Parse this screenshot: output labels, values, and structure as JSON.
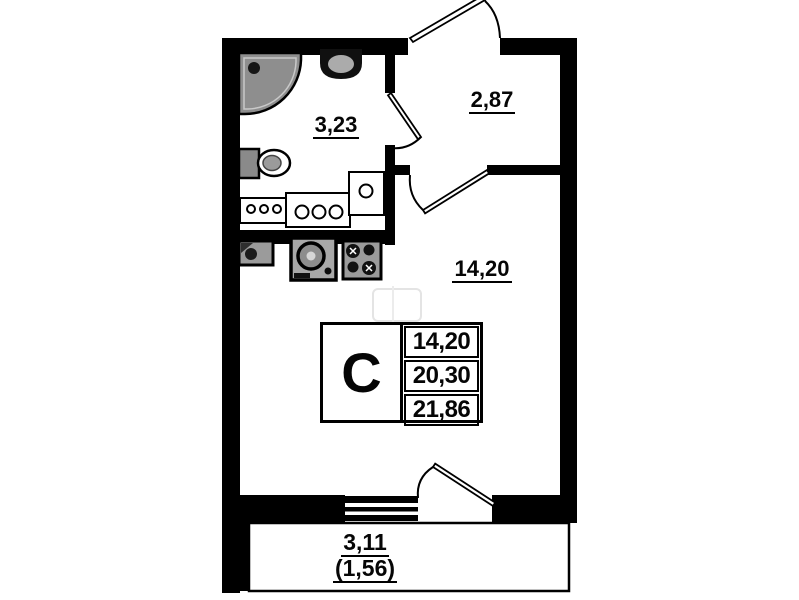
{
  "labels": {
    "bathroom_area": "3,23",
    "hallway_area": "2,87",
    "room_area": "14,20",
    "balcony_area": "3,11",
    "balcony_reduced_area": "(1,56)"
  },
  "info_table": {
    "type_letter": "С",
    "values": [
      "14,20",
      "20,30",
      "21,86"
    ]
  },
  "colors": {
    "wall": "#000000",
    "background": "#ffffff",
    "fixture_fill": "#9b9b9b",
    "shower_fill": "#8e8e8e"
  },
  "icons": [
    "shower-tray-icon",
    "washbasin-icon",
    "toilet-icon",
    "bathroom-counter-icon",
    "kitchen-sink-icon",
    "washing-machine-icon",
    "stove-icon",
    "entrance-door-icon",
    "bathroom-door-icon",
    "room-door-icon",
    "balcony-door-icon",
    "window-icon",
    "balcony-icon"
  ]
}
